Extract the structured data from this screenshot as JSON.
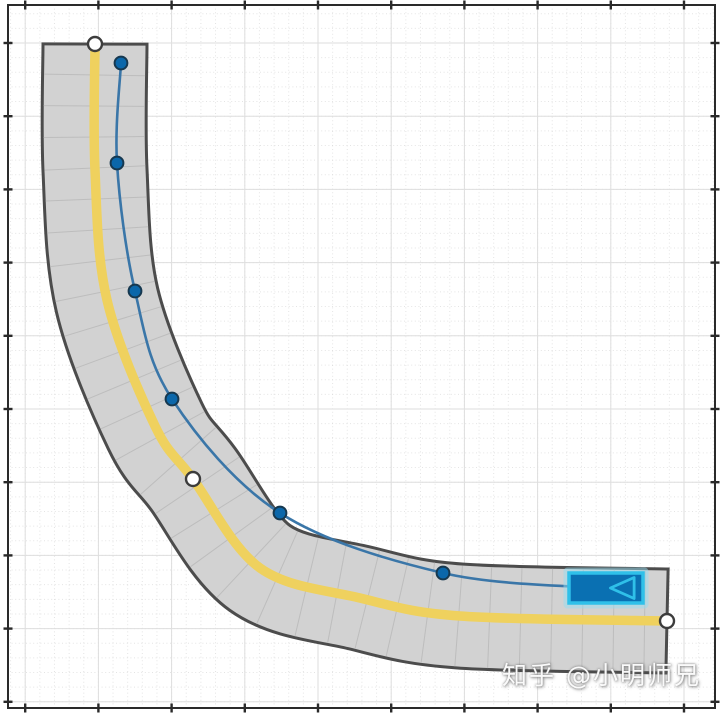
{
  "canvas": {
    "width": 720,
    "height": 713,
    "background": "#ffffff"
  },
  "watermark": {
    "text": "知乎 @小明师兄",
    "color": "#fdfdfd"
  },
  "axes": {
    "plot_area": {
      "x1": 8,
      "y1": 5,
      "x2": 715,
      "y2": 708
    },
    "frame_color": "#2a2a2a",
    "frame_width": 2,
    "ticks": {
      "x_start": 25.2,
      "y_start": 43,
      "major_spacing": 73.2,
      "minor_divisions": 5,
      "length": 9,
      "width": 2.4,
      "color": "#2a2a2a",
      "labels_visible": false
    },
    "grid": {
      "major_color": "#dedede",
      "major_width": 1,
      "minor_color": "#cfcfcf",
      "minor_dash": "1,2.6",
      "minor_opacity": 0.55
    }
  },
  "chart_data": {
    "type": "scatter",
    "title": "",
    "xlabel": "",
    "ylabel": "",
    "note": "Curved two-lane road with ego-vehicle trajectory on a gridded axes canvas; no numeric tick labels are shown, coordinates below are canvas pixels",
    "road": {
      "surface_color": "#d2d2d2",
      "edge_color": "#4c4c4c",
      "edge_width": 3,
      "width_px": 101,
      "segment_line_color": "#bdbdbd",
      "segment_spacing_px": 31,
      "center_marking": {
        "color": "#efd15e",
        "width_px": 9.5
      },
      "centerline_px": [
        [
          95,
          44
        ],
        [
          95,
          170
        ],
        [
          107,
          300
        ],
        [
          155,
          426
        ],
        [
          193,
          479
        ],
        [
          260,
          568
        ],
        [
          360,
          598
        ],
        [
          460,
          616
        ],
        [
          667,
          621
        ]
      ],
      "waypoints_px": [
        [
          95,
          44
        ],
        [
          193,
          479
        ],
        [
          667,
          621
        ]
      ],
      "waypoint_style": {
        "fill": "#ffffff",
        "stroke": "#3c3c3c",
        "stroke_width": 2.4,
        "radius": 7
      }
    },
    "trajectory": {
      "line_color": "#3a76a8",
      "line_width": 2.6,
      "path_px": [
        [
          121,
          63
        ],
        [
          117,
          163
        ],
        [
          135,
          291
        ],
        [
          172,
          399
        ],
        [
          280,
          513
        ],
        [
          443,
          573
        ],
        [
          598,
          588
        ]
      ],
      "waypoints_px": [
        [
          121,
          63
        ],
        [
          117,
          163
        ],
        [
          135,
          291
        ],
        [
          172,
          399
        ],
        [
          280,
          513
        ],
        [
          443,
          573
        ]
      ],
      "waypoint_style": {
        "fill": "#0b67aa",
        "stroke": "#16384f",
        "stroke_width": 2,
        "radius": 6.4
      }
    },
    "vehicle": {
      "x": 569,
      "y": 573,
      "width": 74,
      "height": 30,
      "body_color": "#0a70b2",
      "outline_color": "#2fc0e9",
      "outline_width": 3.5,
      "halo_color": "rgba(150,220,240,0.5)",
      "heading": "left"
    }
  }
}
